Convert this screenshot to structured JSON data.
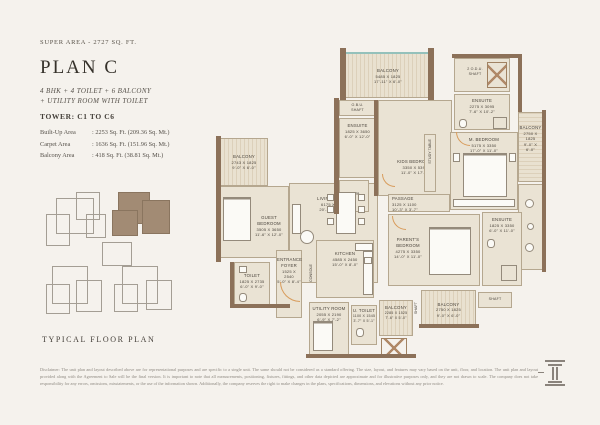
{
  "header": {
    "super_area": "SUPER AREA - 2727 SQ. FT.",
    "title": "PLAN C",
    "subtitle_line1": "4 BHK + 4 TOILET + 6 BALCONY",
    "subtitle_line2": "+ UTILITY ROOM WITH TOILET",
    "tower": "TOWER: C1 TO C6"
  },
  "areas": [
    {
      "label": "Built-Up Area",
      "value": ": 2253 Sq. Ft. (209.36 Sq. Mt.)"
    },
    {
      "label": "Carpet Area",
      "value": ": 1636 Sq. Ft. (151.96 Sq. Mt.)"
    },
    {
      "label": "Balcony Area",
      "value": ": 418 Sq. Ft. (38.81 Sq. Mt.)"
    }
  ],
  "key_plan": {
    "caption": "TYPICAL FLOOR PLAN"
  },
  "rooms": {
    "balcony_top": {
      "name": "BALCONY",
      "mm": "5485 X 1825",
      "ft": "17'-11\" X 6'-0\""
    },
    "obu": {
      "line1": "O.B.U.",
      "line2": "SHAFT"
    },
    "ensuite_kids": {
      "name": "ENSUITE",
      "mm": "1825 X 3650",
      "ft": "6'-0\" X 12'-0\""
    },
    "kids": {
      "name": "KIDS BEDROOM",
      "mm": "3350 X 5395",
      "ft": "11'-0\" X 17'-8\""
    },
    "puja": {
      "name": "PUJA"
    },
    "odu": {
      "name": "2 O.D.U.",
      "shaft": "SHAFT"
    },
    "ensuite_master": {
      "name": "ENSUITE",
      "mm": "2275 X 3095",
      "ft": "7'-6\" X 10'-2\""
    },
    "balcony_right": {
      "name": "BALCONY",
      "mm": "2750 X 1825",
      "ft": "9'-0\" X 6'-0\""
    },
    "master": {
      "name": "M. BEDROOM",
      "mm": "5175 X 3350",
      "ft": "17'-0\" X 11'-0\""
    },
    "study": {
      "name": "STUDY TABLE"
    },
    "passage": {
      "name": "PASSAGE",
      "mm": "3125 X 1100",
      "ft": "10'-3\" X 3'-7\""
    },
    "parents": {
      "name": "PARENT'S BEDROOM",
      "mm": "4275 X 3350",
      "ft": "14'-0\" X 11'-0\""
    },
    "ensuite_parents": {
      "name": "ENSUITE",
      "mm": "1825 X 3350",
      "ft": "6'-0\" X 11'-0\""
    },
    "balcony_br": {
      "name": "BALCONY",
      "mm": "2750 X 1825",
      "ft": "9'-0\" X 6'-0\""
    },
    "shaft_right": {
      "name": "SHAFT"
    },
    "balcony_left": {
      "name": "BALCONY",
      "mm": "2743 X 1825",
      "ft": "9'-0\" X 6'-0\""
    },
    "guest": {
      "name": "GUEST BEDROOM",
      "mm": "3505 X 3650",
      "ft": "11'-6\" X 12'-0\""
    },
    "living": {
      "name": "LIVING/DINING",
      "mm": "6175 X 5475",
      "ft": "20'-3\" X 18'-0\""
    },
    "foyer": {
      "name": "ENTRANCE FOYER",
      "mm": "1525 X 2540",
      "ft": "5'-0\" X 8'-4\""
    },
    "console": {
      "name": "CONSOLE"
    },
    "kitchen": {
      "name": "KITCHEN",
      "mm": "4585 X 2450",
      "ft": "15'-0\" X 8'-0\""
    },
    "toilet": {
      "name": "TOILET",
      "mm": "1825 X 2735",
      "ft": "6'-0\" X 9'-0\""
    },
    "utility": {
      "name": "UTILITY ROOM",
      "mm": "2055 X 2190",
      "ft": "6'-9\" X 7'-2\""
    },
    "u_toilet": {
      "name": "U. TOILET",
      "mm": "1100 X 1545",
      "ft": "3'-7\" X 5'-1\""
    },
    "balcony_small": {
      "name": "BALCONY",
      "mm": "2285 X 1525",
      "ft": "7'-6\" X 5'-0\""
    },
    "shaft_bottom": {
      "name": "SHAFT"
    }
  },
  "footer": {
    "disclaimer": "Disclaimer: The unit plan and layout described above are for representational purposes and are specific to a single unit. The same should not be considered as a standard offering. The size, layout, and features may vary based on the unit, floor, and location. The unit plan and layout provided along with the Agreement to Sale will be the final version. It is important to note that all measurements, positioning, fixtures, fittings, and other data depicted are approximate and for illustrative purposes only, and they are not drawn to scale. The company does not take responsibility for any errors, omissions, misstatements, or the use of the information shown. Additionally, the company reserves the right to make changes in the plans, specifications, dimensions, and elevations without any prior notice."
  },
  "colors": {
    "page_bg": "#f5f2ed",
    "wall": "#8c7159",
    "room_fill": "#eae3d4",
    "glass": "#94c1bb",
    "highlight_unit": "#a28b74",
    "door_swing": "#d89c5c"
  }
}
